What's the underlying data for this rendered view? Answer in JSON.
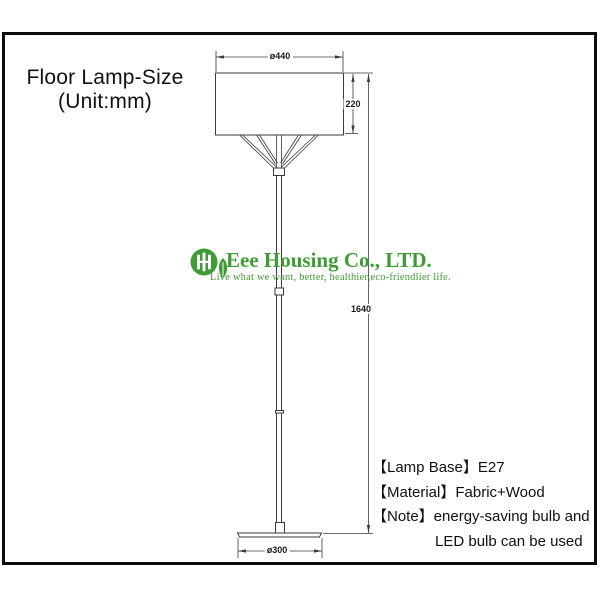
{
  "title": {
    "line1": "Floor Lamp-Size",
    "line2": "(Unit:mm)"
  },
  "dimensions": {
    "shade_diameter": "ø440",
    "shade_height": "220",
    "total_height": "1640",
    "base_diameter": "ø300"
  },
  "logo": {
    "company": "Eee Housing Co., LTD.",
    "tagline": "Live what we want, better, healthier,eco-friendlier life.",
    "brand_color": "#3E9B35"
  },
  "specs": {
    "lines": [
      "【Lamp Base】E27",
      "【Material】Fabric+Wood",
      "【Note】energy-saving bulb and",
      "LED bulb can be used"
    ]
  },
  "drawing": {
    "line_color": "#3a3a3a"
  }
}
